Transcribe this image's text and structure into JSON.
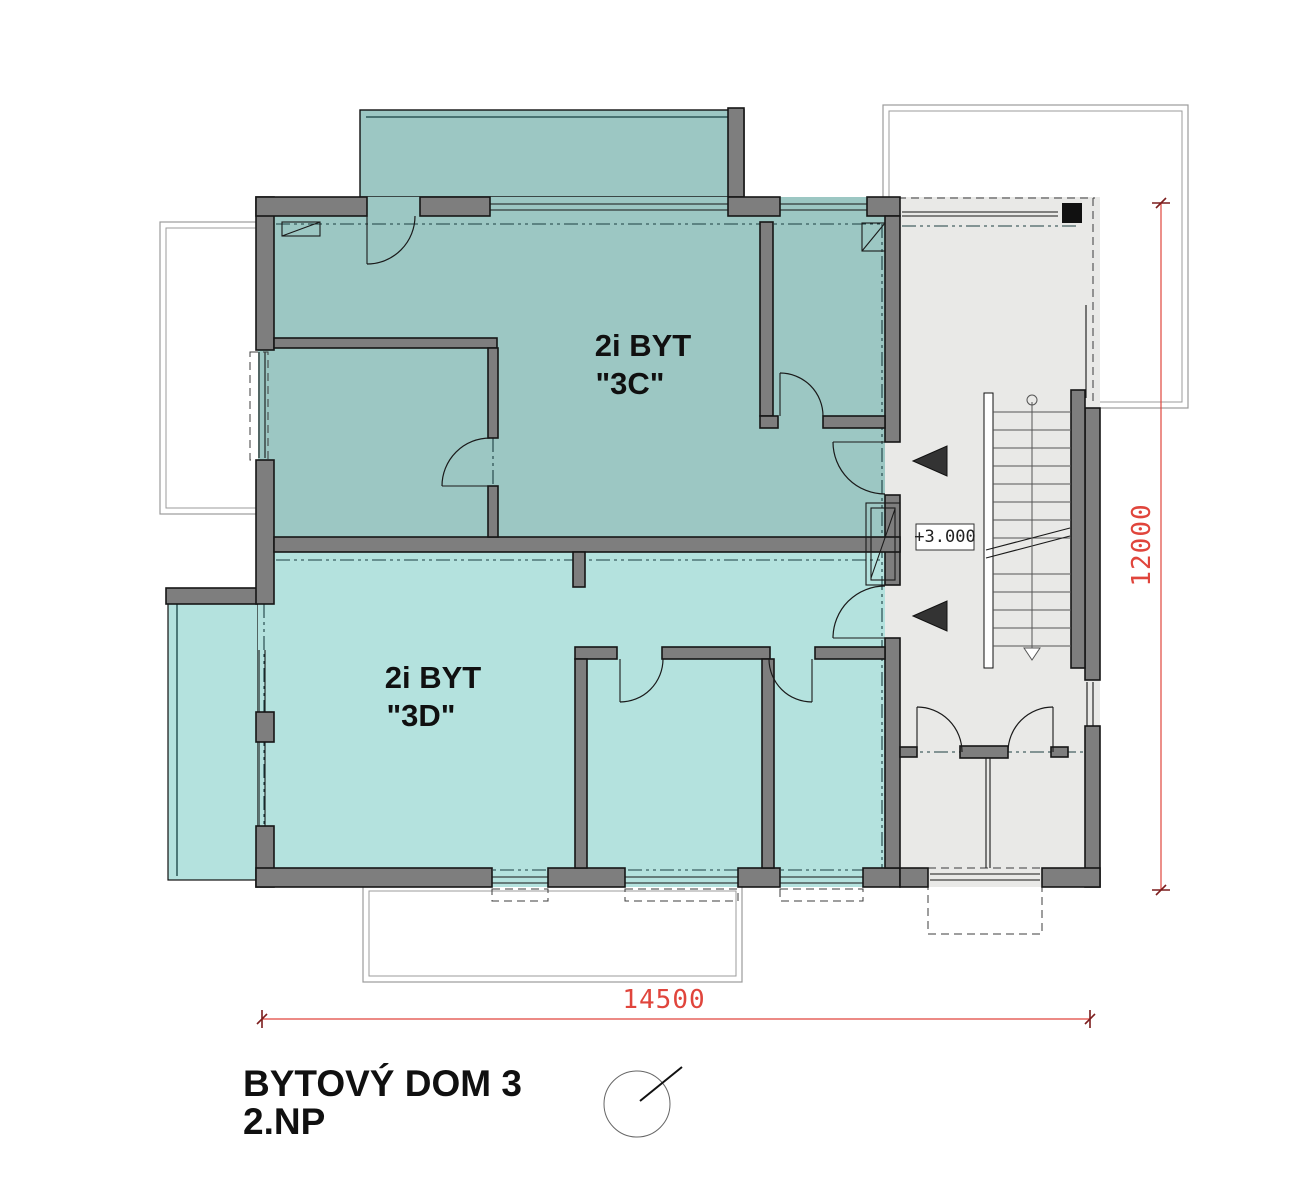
{
  "colors": {
    "apartment_3c_fill": "#9cc7c3",
    "apartment_3d_fill": "#b4e2de",
    "stairwell_fill": "#e9e9e7",
    "wall_fill": "#7e7e7e",
    "dimension_red": "#e0453c"
  },
  "plan": {
    "title_line1": "BYTOVÝ DOM 3",
    "title_line2": "2.NP",
    "apartment_3c": {
      "name_line1": "2i BYT",
      "name_line2": "\"3C\""
    },
    "apartment_3d": {
      "name_line1": "2i BYT",
      "name_line2": "\"3D\""
    },
    "elevation_label": "+3.000",
    "dimension_bottom": "14500",
    "dimension_right": "12000"
  }
}
